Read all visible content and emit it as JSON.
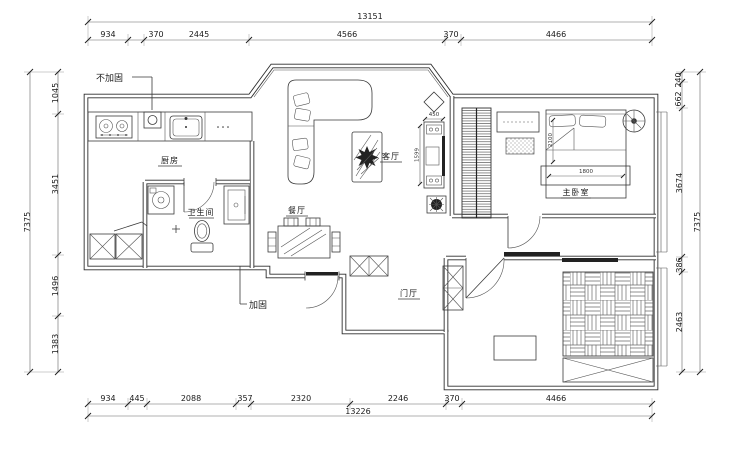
{
  "annotations": {
    "top_left": "不加固",
    "bottom": "加固"
  },
  "rooms": {
    "kitchen": "厨房",
    "bathroom": "卫生间",
    "living": "客厅",
    "dining": "餐厅",
    "hall": "门厅",
    "master_bedroom": "主卧室"
  },
  "dims": {
    "top": {
      "total": "13151",
      "segments": [
        "934",
        "370",
        "2445",
        "4566",
        "370",
        "4466"
      ]
    },
    "bottom": {
      "total": "13226",
      "segments": [
        "934",
        "445",
        "2088",
        "357",
        "2320",
        "2246",
        "370",
        "4466"
      ]
    },
    "left": {
      "total": "7375",
      "segments": [
        "1045",
        "3451",
        "1496",
        "1383"
      ]
    },
    "right": {
      "total": "7375",
      "segments": [
        "240",
        "662",
        "3674",
        "386",
        "2463"
      ]
    },
    "furniture": {
      "tv_width": "450",
      "tv_length": "1599",
      "bed_width": "1800",
      "bed_length": "2100"
    }
  },
  "colors": {
    "line": "#333333",
    "background": "#ffffff"
  }
}
